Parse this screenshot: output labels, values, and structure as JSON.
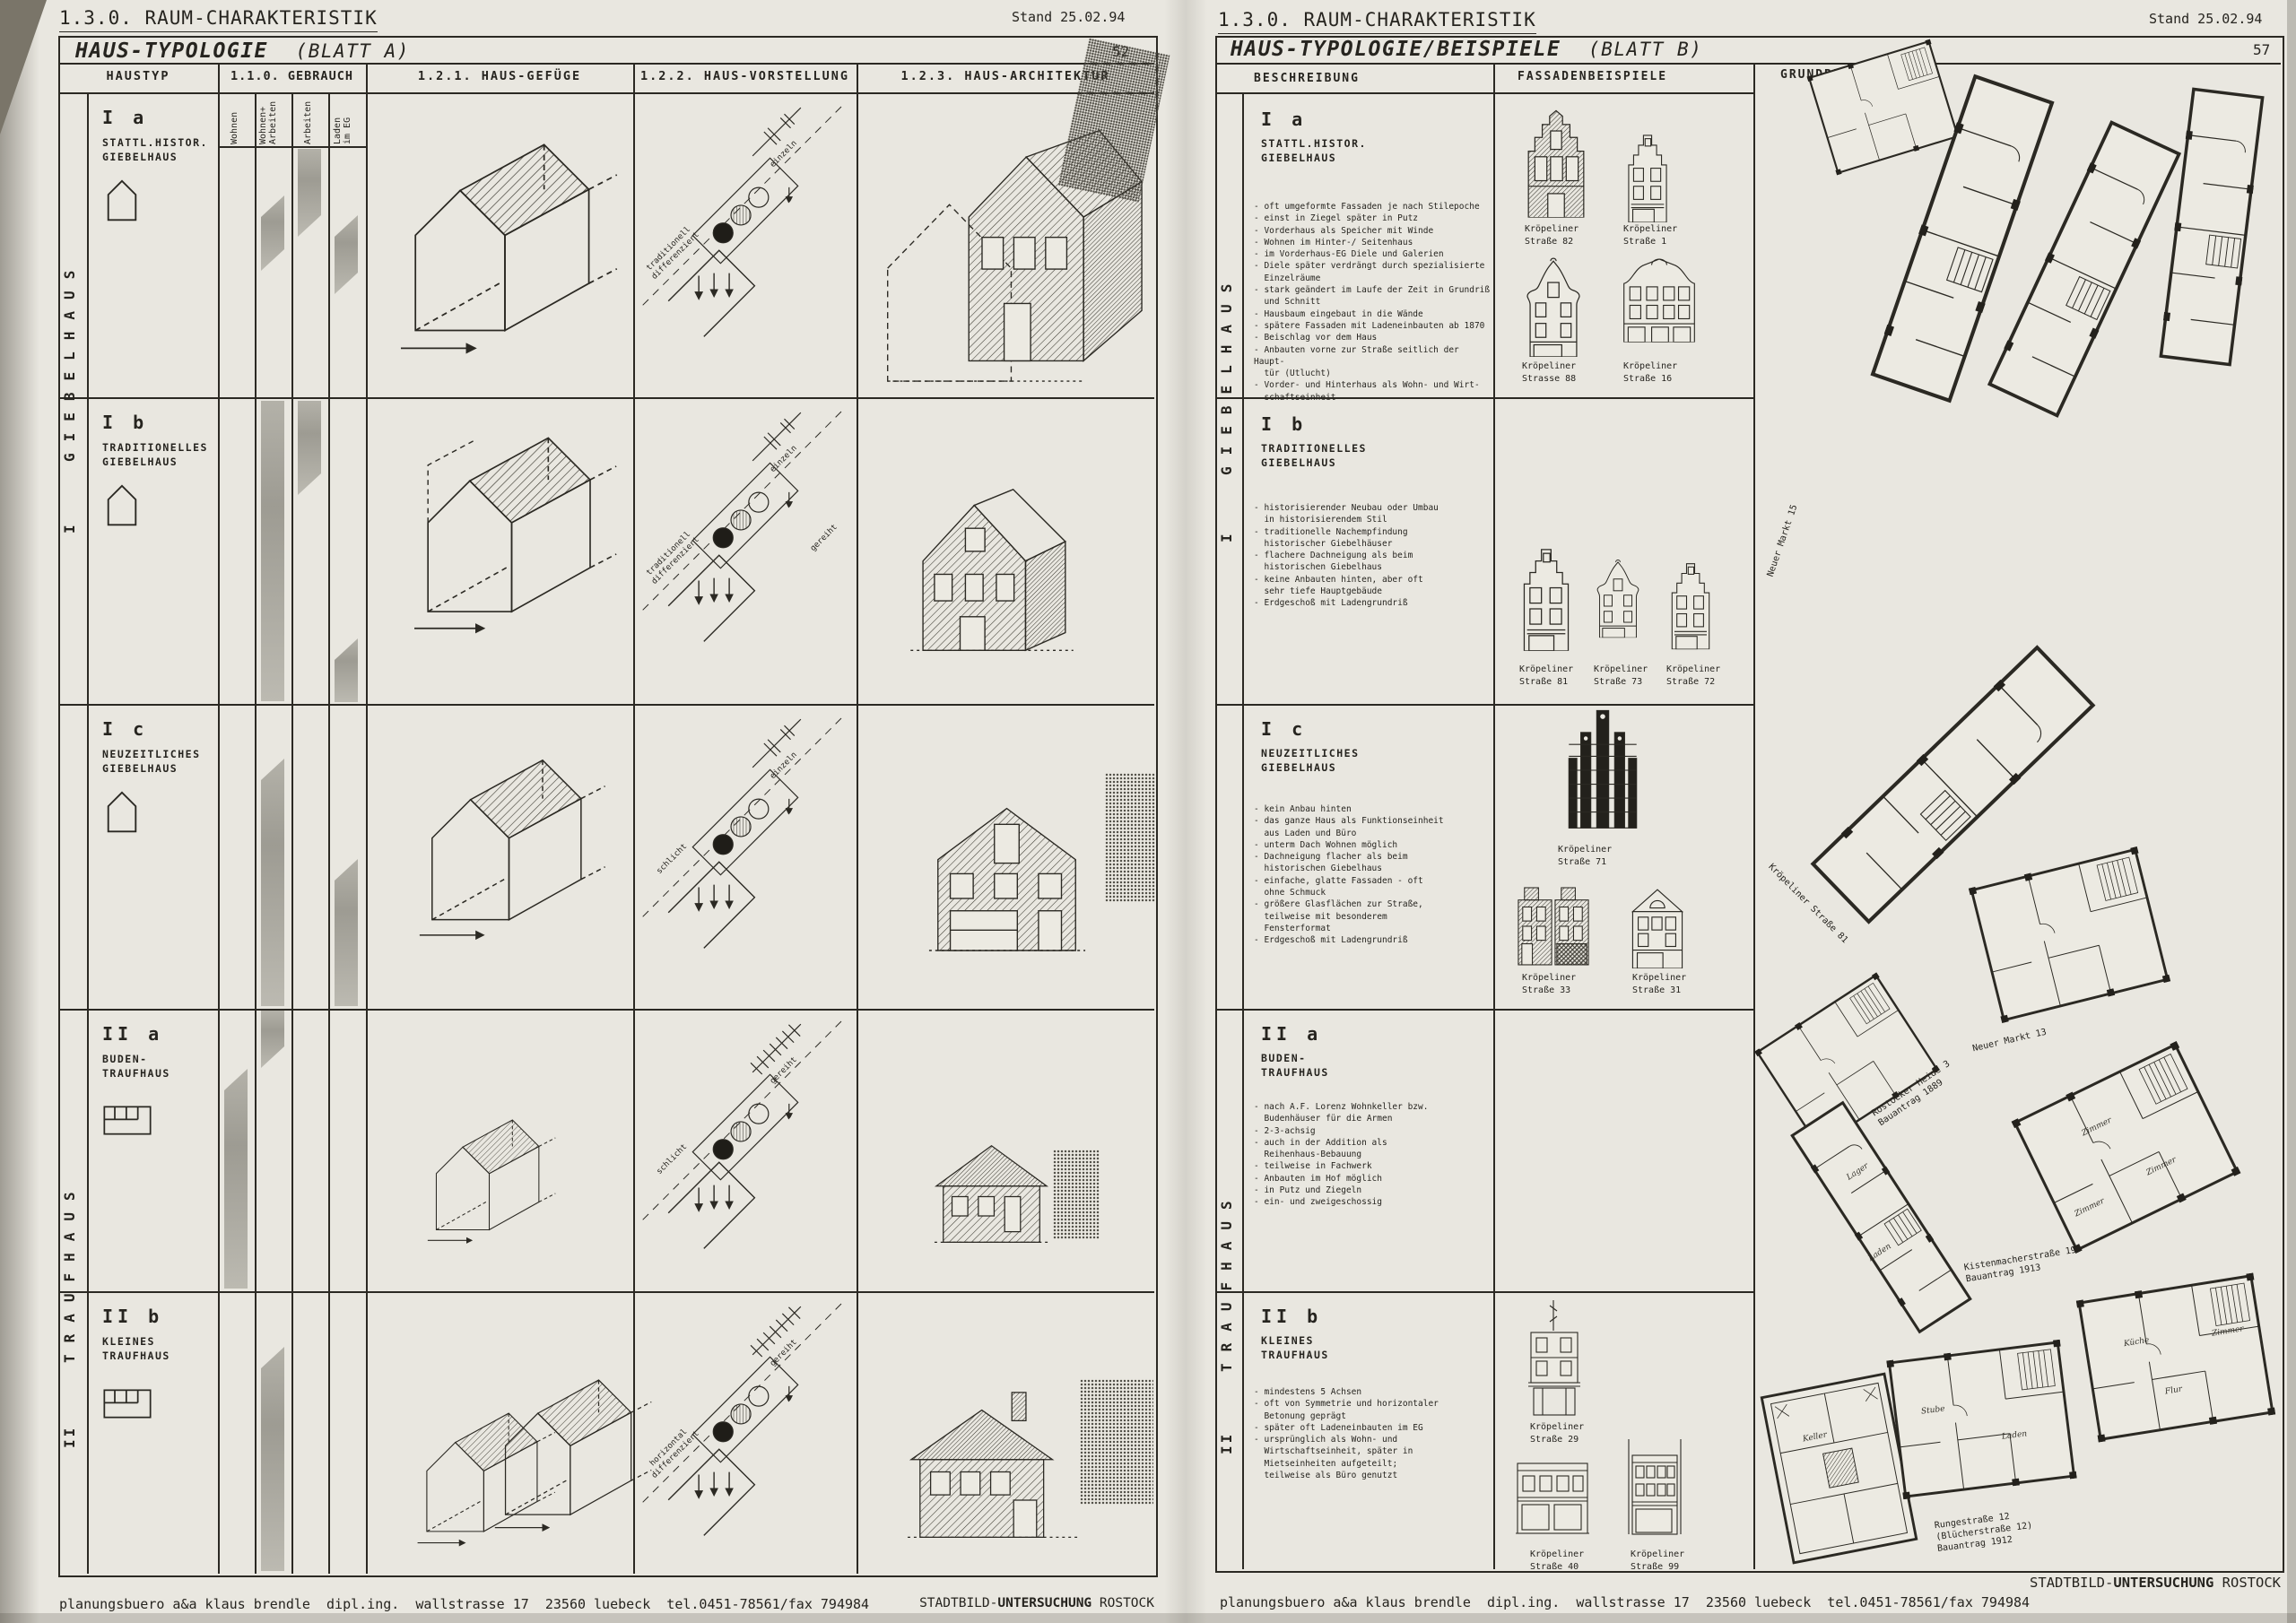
{
  "left": {
    "doc_header": "1.3.0. RAUM-CHARAKTERISTIK",
    "stand": "Stand 25.02.94",
    "title": "HAUS-TYPOLOGIE",
    "subtitle": "(BLATT A)",
    "page_no": "52",
    "col_haustyp": "HAUSTYP",
    "col_gebrauch": "1.1.0. GEBRAUCH",
    "col_gefuege": "1.2.1. HAUS-GEFÜGE",
    "col_vorstellung": "1.2.2. HAUS-VORSTELLUNG",
    "col_architektur": "1.2.3. HAUS-ARCHITEKTUR",
    "gebrauch_sub": [
      "Wohnen",
      "Wohnen+\nArbeiten",
      "Arbeiten",
      "Laden\nim EG"
    ],
    "group1_no": "I",
    "group1_label": "GIEBELHAUS",
    "group2_no": "II",
    "group2_label": "TRAUFHAUS",
    "rows": [
      {
        "code": "I a",
        "name": "STATTL.HISTOR.\nGIEBELHAUS",
        "top": "einzeln",
        "mid": "",
        "bottom": "traditionell\ndifferenziert"
      },
      {
        "code": "I b",
        "name": "TRADITIONELLES\nGIEBELHAUS",
        "top": "einzeln",
        "mid": "gereiht",
        "bottom": "traditionell\ndifferenziert"
      },
      {
        "code": "I c",
        "name": "NEUZEITLICHES\nGIEBELHAUS",
        "top": "einzeln",
        "mid": "",
        "bottom": "schlicht"
      },
      {
        "code": "II a",
        "name": "BUDEN-\nTRAUFHAUS",
        "top": "gereiht",
        "mid": "",
        "bottom": "schlicht"
      },
      {
        "code": "II b",
        "name": "KLEINES\nTRAUFHAUS",
        "top": "gereiht",
        "mid": "",
        "bottom": "horizontal\ndifferenziert"
      }
    ],
    "footer": "planungsbuero a&a klaus brendle  dipl.ing.  wallstrasse 17  23560 luebeck  tel.0451-78561/fax 794984",
    "brand1": "STADTBILD-",
    "brand2": "UNTERSUCHUNG",
    "brand3": " ROSTOCK"
  },
  "right": {
    "doc_header": "1.3.0. RAUM-CHARAKTERISTIK",
    "stand": "Stand 25.02.94",
    "title": "HAUS-TYPOLOGIE/BEISPIELE",
    "subtitle": "(BLATT B)",
    "page_no": "57",
    "col_beschreibung": "BESCHREIBUNG",
    "col_fassaden": "FASSADENBEISPIELE",
    "col_grundriss": "GRUNDRISSBEISPIELE",
    "group1_no": "I",
    "group1_label": "GIEBELHAUS",
    "group2_no": "II",
    "group2_label": "TRAUFHAUS",
    "sections": [
      {
        "code": "I a",
        "name": "STATTL.HISTOR.\nGIEBELHAUS",
        "bullets": "- oft umgeformte Fassaden je nach Stilepoche\n- einst in Ziegel später in Putz\n- Vorderhaus als Speicher mit Winde\n- Wohnen im Hinter-/ Seitenhaus\n- im Vorderhaus-EG Diele und Galerien\n- Diele später verdrängt durch spezialisierte\n  Einzelräume\n- stark geändert im Laufe der Zeit in Grundriß\n  und Schnitt\n- Hausbaum eingebaut in die Wände\n- spätere Fassaden mit Ladeneinbauten ab 1870\n- Beischlag vor dem Haus\n- Anbauten vorne zur Straße seitlich der Haupt-\n  tür (Utlucht)\n- Vorder- und Hinterhaus als Wohn- und Wirt-\n  schaftseinheit"
      },
      {
        "code": "I b",
        "name": "TRADITIONELLES\nGIEBELHAUS",
        "bullets": "- historisierender Neubau oder Umbau\n  in historisierendem Stil\n- traditionelle Nachempfindung\n  historischer Giebelhäuser\n- flachere Dachneigung als beim\n  historischen Giebelhaus\n- keine Anbauten hinten, aber oft\n  sehr tiefe Hauptgebäude\n- Erdgeschoß mit Ladengrundriß"
      },
      {
        "code": "I c",
        "name": "NEUZEITLICHES\nGIEBELHAUS",
        "bullets": "- kein Anbau hinten\n- das ganze Haus als Funktionseinheit\n  aus Laden und Büro\n- unterm Dach Wohnen möglich\n- Dachneigung flacher als beim\n  historischen Giebelhaus\n- einfache, glatte Fassaden - oft\n  ohne Schmuck\n- größere Glasflächen zur Straße,\n  teilweise mit besonderem\n  Fensterformat\n- Erdgeschoß mit Ladengrundriß"
      },
      {
        "code": "II a",
        "name": "BUDEN-\nTRAUFHAUS",
        "bullets": "- nach A.F. Lorenz Wohnkeller bzw.\n  Budenhäuser für die Armen\n- 2-3-achsig\n- auch in der Addition als\n  Reihenhaus-Bebauung\n- teilweise in Fachwerk\n- Anbauten im Hof möglich\n- in Putz und Ziegeln\n- ein- und zweigeschossig"
      },
      {
        "code": "II b",
        "name": "KLEINES\nTRAUFHAUS",
        "bullets": "- mindestens 5 Achsen\n- oft von Symmetrie und horizontaler\n  Betonung geprägt\n- später oft Ladeneinbauten im EG\n- ursprünglich als Wohn- und\n  Wirtschaftseinheit, später in\n  Mietseinheiten aufgeteilt;\n  teilweise als Büro genutzt"
      }
    ],
    "facade_captions": {
      "f82": "Kröpeliner\nStraße 82",
      "f1": "Kröpeliner\nStraße 1",
      "f88": "Kröpeliner\nStrasse 88",
      "f16": "Kröpeliner\nStraße 16",
      "f81": "Kröpeliner\nStraße 81",
      "f73": "Kröpeliner\nStraße 73",
      "f72": "Kröpeliner\nStraße 72",
      "f71": "Kröpeliner\nStraße 71",
      "f33": "Kröpeliner\nStraße 33",
      "f31": "Kröpeliner\nStraße 31",
      "f29": "Kröpeliner\nStraße 29",
      "f40": "Kröpeliner\nStraße 40",
      "f99": "Kröpeliner\nStraße 99"
    },
    "plan_captions": {
      "nm15": "Neuer Markt 15",
      "kr81": "Kröpeliner Straße 81",
      "nm13": "Neuer Markt 13",
      "rh3": "Rostocker Heide 3\nBauantrag 1889",
      "ki19": "Kistenmacherstraße 19\nBauantrag 1913",
      "ru12": "Rungestraße 12\n(Blücherstraße 12)\nBauantrag 1912"
    },
    "room_labels": {
      "keller": "Keller",
      "laden": "Laden",
      "lager": "Lager",
      "stube": "Stube",
      "zimmer": "Zimmer",
      "kueche": "Küche",
      "flur": "Flur"
    },
    "footer": "planungsbuero a&a klaus brendle  dipl.ing.  wallstrasse 17  23560 luebeck  tel.0451-78561/fax 794984",
    "brand1": "STADTBILD-",
    "brand2": "UNTERSUCHUNG",
    "brand3": " ROSTOCK"
  }
}
